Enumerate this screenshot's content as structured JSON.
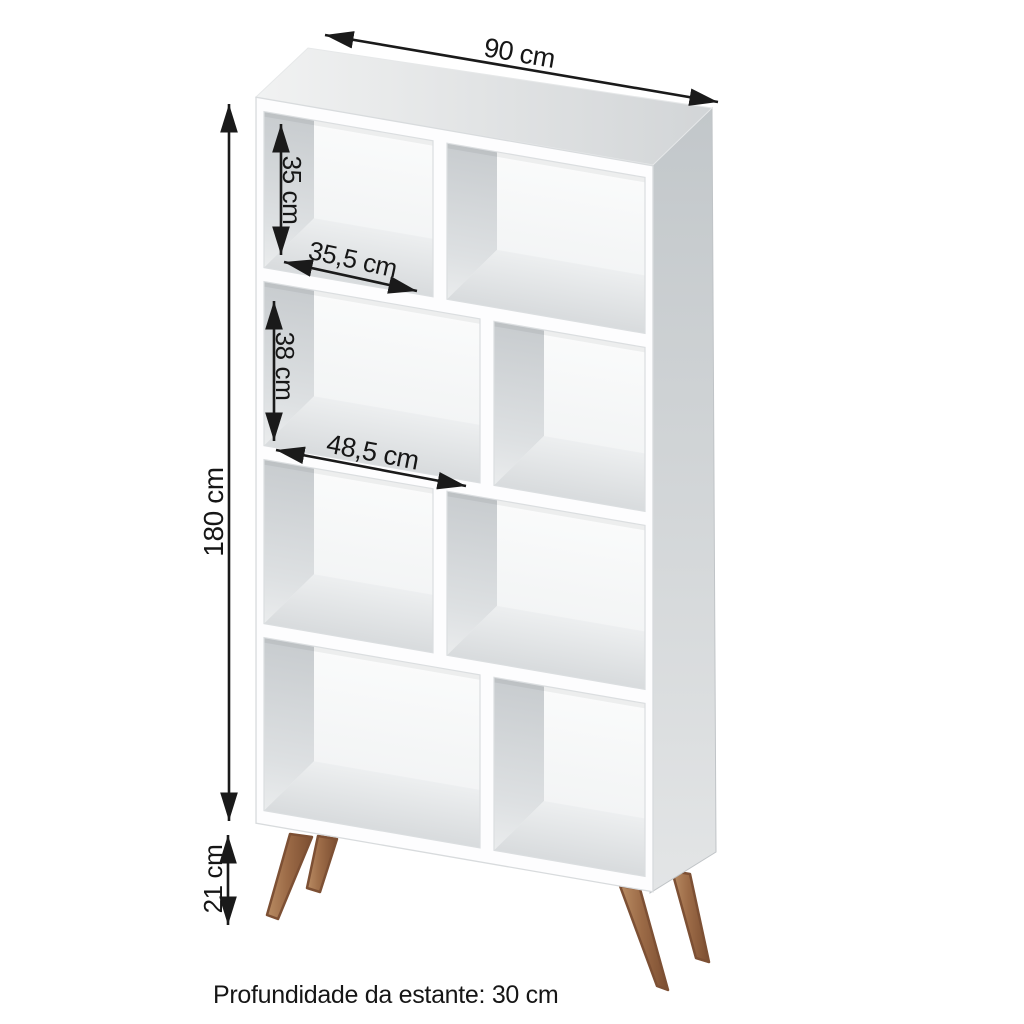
{
  "labels": {
    "width": "90 cm",
    "height": "180 cm",
    "leg_height": "21 cm",
    "small_compartment_height": "35 cm",
    "small_compartment_width": "35,5 cm",
    "large_compartment_height": "38 cm",
    "large_compartment_width": "48,5 cm",
    "depth_note": "Profundidade da estante: 30 cm"
  },
  "structure": {
    "rows": 4,
    "columns": 2,
    "compartments": 8,
    "legs": 4
  },
  "colors": {
    "background": "#ffffff",
    "cabinet_front": "#fdfdfe",
    "cabinet_side": "#c8ccce",
    "cabinet_top": "#e3e5e6",
    "interior_wall": "#c9cdd0",
    "interior_floor": "#dcdfe1",
    "leg_wood": "#9c6b47",
    "dimension_ink": "#1a1a1a"
  }
}
